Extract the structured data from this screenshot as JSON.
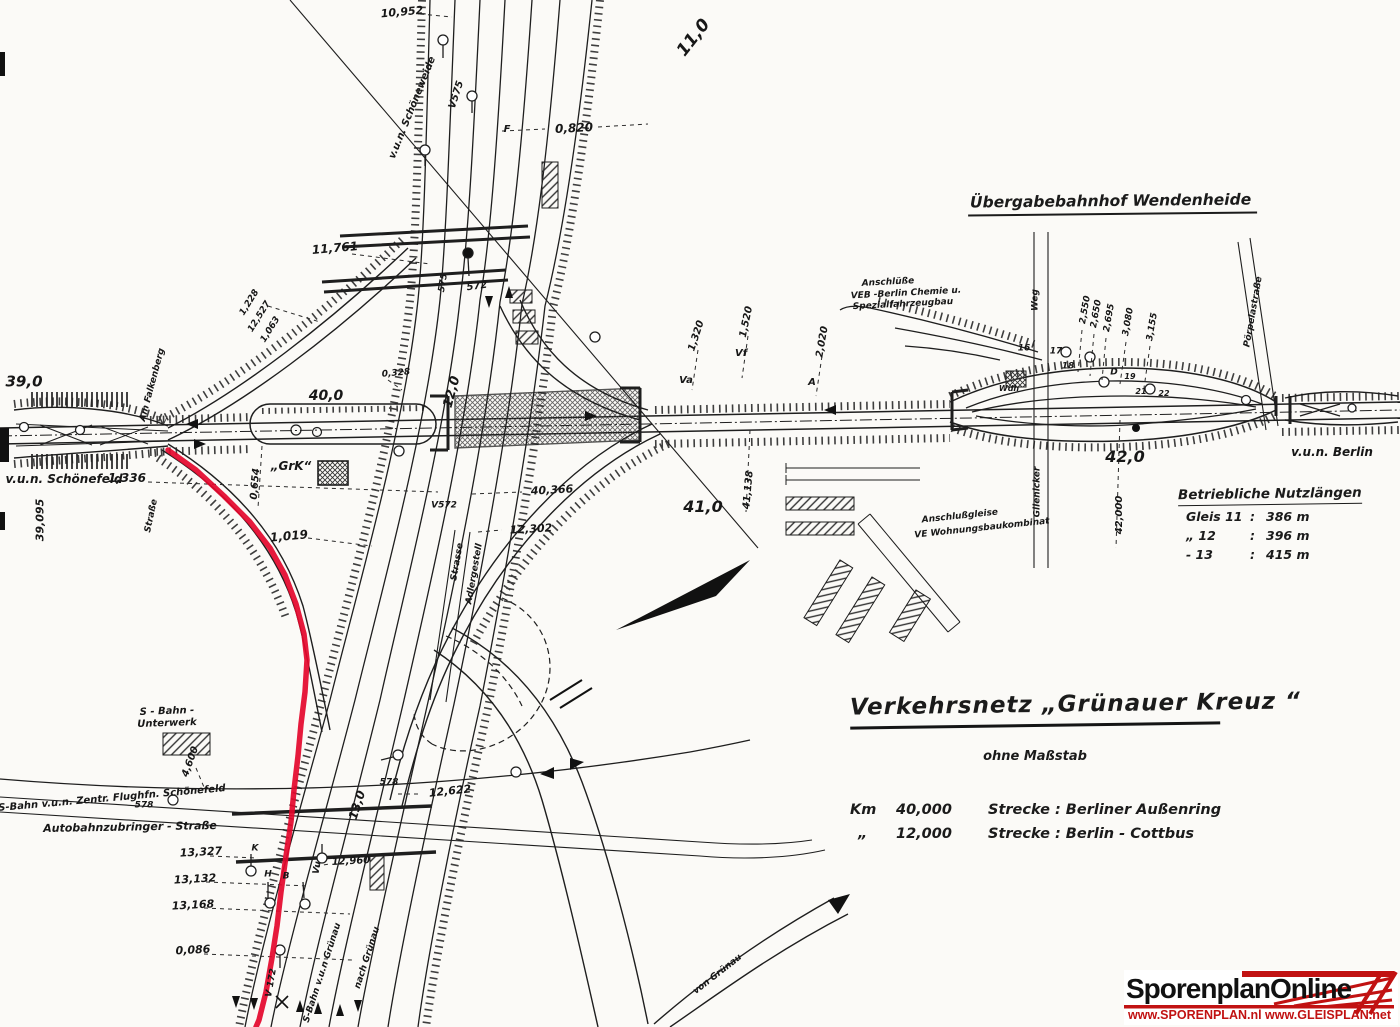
{
  "colors": {
    "ink": "#222222",
    "route_red": "#e4062b",
    "logo_red": "#c11212"
  },
  "station_header": {
    "text": "Übergabebahnhof  Wendenheide"
  },
  "title_block": {
    "title": "Verkehrsnetz  „Grünauer  Kreuz “",
    "subtitle": "ohne Maßstab",
    "rows": [
      {
        "km_label": "Km",
        "km": "40,000",
        "strecke": "Strecke :  Berliner Außenring"
      },
      {
        "km_label": "„",
        "km": "12,000",
        "strecke": "Strecke :  Berlin - Cottbus"
      }
    ]
  },
  "nutzlaengen": {
    "heading": "Betriebliche Nutzlängen",
    "rows": [
      {
        "gleis": "Gleis 11",
        "sep": ":",
        "len": "386 m"
      },
      {
        "gleis": "„     12",
        "sep": ":",
        "len": "396 m"
      },
      {
        "gleis": "-     13",
        "sep": ":",
        "len": "415 m"
      }
    ]
  },
  "logo": {
    "name": "SporenplanOnline",
    "urls": "www.SPORENPLAN.nl   www.GLEISPLAN.net"
  },
  "map_labels": [
    {
      "t": "10,952",
      "x": 402,
      "y": 12,
      "r": -5,
      "s": 11
    },
    {
      "t": "v.u.n. Schöneweide",
      "x": 413,
      "y": 108,
      "r": -68,
      "s": 10
    },
    {
      "t": "V575",
      "x": 457,
      "y": 95,
      "r": -72,
      "s": 10
    },
    {
      "t": "11,0",
      "x": 694,
      "y": 38,
      "r": -52,
      "s": 17
    },
    {
      "t": "F",
      "x": 507,
      "y": 130,
      "r": 0,
      "s": 10
    },
    {
      "t": "0,820",
      "x": 574,
      "y": 128,
      "r": -3,
      "s": 12
    },
    {
      "t": "11,761",
      "x": 335,
      "y": 248,
      "r": -5,
      "s": 12
    },
    {
      "t": "575",
      "x": 444,
      "y": 283,
      "r": -80,
      "s": 9
    },
    {
      "t": "572",
      "x": 477,
      "y": 287,
      "r": -8,
      "s": 10
    },
    {
      "t": "1,228",
      "x": 250,
      "y": 303,
      "r": -58,
      "s": 9
    },
    {
      "t": "12,527",
      "x": 260,
      "y": 317,
      "r": -58,
      "s": 9
    },
    {
      "t": "1,063",
      "x": 271,
      "y": 330,
      "r": -58,
      "s": 9
    },
    {
      "t": "39,0",
      "x": 24,
      "y": 382,
      "r": 0,
      "s": 15
    },
    {
      "t": "v.u.n. Schönefeld",
      "x": 64,
      "y": 479,
      "r": 0,
      "s": 12
    },
    {
      "t": "1,336",
      "x": 127,
      "y": 478,
      "r": 0,
      "s": 12
    },
    {
      "t": "39,095",
      "x": 40,
      "y": 520,
      "r": -90,
      "s": 11
    },
    {
      "t": "Am Falkenberg",
      "x": 153,
      "y": 385,
      "r": -75,
      "s": 9
    },
    {
      "t": "Straße",
      "x": 152,
      "y": 516,
      "r": -78,
      "s": 9
    },
    {
      "t": "40,0",
      "x": 326,
      "y": 396,
      "r": 0,
      "s": 14
    },
    {
      "t": "„GrK“",
      "x": 291,
      "y": 466,
      "r": 0,
      "s": 12
    },
    {
      "t": "0,328",
      "x": 396,
      "y": 374,
      "r": -5,
      "s": 9
    },
    {
      "t": "12,0",
      "x": 452,
      "y": 392,
      "r": -75,
      "s": 13
    },
    {
      "t": "1,019",
      "x": 289,
      "y": 536,
      "r": -5,
      "s": 12
    },
    {
      "t": "0,654",
      "x": 256,
      "y": 484,
      "r": -85,
      "s": 10
    },
    {
      "t": "V572",
      "x": 444,
      "y": 506,
      "r": 0,
      "s": 9
    },
    {
      "t": "40,366",
      "x": 552,
      "y": 490,
      "r": -3,
      "s": 11
    },
    {
      "t": "12,302",
      "x": 531,
      "y": 529,
      "r": -3,
      "s": 11
    },
    {
      "t": "Strasse",
      "x": 458,
      "y": 562,
      "r": -80,
      "s": 9
    },
    {
      "t": "Adlergestell",
      "x": 475,
      "y": 574,
      "r": -80,
      "s": 9
    },
    {
      "t": "41,0",
      "x": 703,
      "y": 507,
      "r": 0,
      "s": 16
    },
    {
      "t": "41,138",
      "x": 749,
      "y": 490,
      "r": -85,
      "s": 10
    },
    {
      "t": "1,320",
      "x": 697,
      "y": 336,
      "r": -72,
      "s": 10
    },
    {
      "t": "1,520",
      "x": 747,
      "y": 322,
      "r": -78,
      "s": 10
    },
    {
      "t": "2,020",
      "x": 823,
      "y": 342,
      "r": -80,
      "s": 10
    },
    {
      "t": "Vf",
      "x": 741,
      "y": 354,
      "r": 0,
      "s": 10
    },
    {
      "t": "Va",
      "x": 686,
      "y": 381,
      "r": 0,
      "s": 10
    },
    {
      "t": "A",
      "x": 812,
      "y": 383,
      "r": 0,
      "s": 10
    },
    {
      "t": "Anschlüße",
      "x": 888,
      "y": 283,
      "r": -3,
      "s": 9
    },
    {
      "t": "VEB -Berlin Chemie u.",
      "x": 906,
      "y": 294,
      "r": -3,
      "s": 9
    },
    {
      "t": "Spezialfahrzeugbau",
      "x": 903,
      "y": 305,
      "r": -3,
      "s": 9
    },
    {
      "t": "Weg",
      "x": 1036,
      "y": 300,
      "r": -90,
      "s": 9
    },
    {
      "t": "2,550",
      "x": 1086,
      "y": 310,
      "r": -80,
      "s": 9
    },
    {
      "t": "2,650",
      "x": 1097,
      "y": 314,
      "r": -80,
      "s": 9
    },
    {
      "t": "2,695",
      "x": 1110,
      "y": 318,
      "r": -80,
      "s": 9
    },
    {
      "t": "3,080",
      "x": 1129,
      "y": 322,
      "r": -80,
      "s": 9
    },
    {
      "t": "3,155",
      "x": 1153,
      "y": 327,
      "r": -80,
      "s": 9
    },
    {
      "t": "16",
      "x": 1024,
      "y": 349,
      "r": 0,
      "s": 9
    },
    {
      "t": "17",
      "x": 1056,
      "y": 352,
      "r": 0,
      "s": 9
    },
    {
      "t": "18",
      "x": 1068,
      "y": 367,
      "r": 0,
      "s": 9
    },
    {
      "t": "D",
      "x": 1114,
      "y": 373,
      "r": 0,
      "s": 9
    },
    {
      "t": "19",
      "x": 1130,
      "y": 377,
      "r": 0,
      "s": 8
    },
    {
      "t": "21",
      "x": 1141,
      "y": 392,
      "r": 0,
      "s": 8
    },
    {
      "t": "22",
      "x": 1164,
      "y": 394,
      "r": 0,
      "s": 8
    },
    {
      "t": "Wdh",
      "x": 1009,
      "y": 389,
      "r": 0,
      "s": 8
    },
    {
      "t": "Pörpelastraße",
      "x": 1254,
      "y": 312,
      "r": -80,
      "s": 9
    },
    {
      "t": "42,0",
      "x": 1125,
      "y": 457,
      "r": 0,
      "s": 16
    },
    {
      "t": "42,000",
      "x": 1120,
      "y": 515,
      "r": -90,
      "s": 10
    },
    {
      "t": "v.u.n. Berlin",
      "x": 1332,
      "y": 452,
      "r": 0,
      "s": 12
    },
    {
      "t": "Glienicker",
      "x": 1038,
      "y": 492,
      "r": -90,
      "s": 9
    },
    {
      "t": "Anschlußgleise",
      "x": 960,
      "y": 517,
      "r": -6,
      "s": 9
    },
    {
      "t": "VE Wohnungsbaukombinat",
      "x": 982,
      "y": 529,
      "r": -6,
      "s": 9
    },
    {
      "t": "S - Bahn -",
      "x": 167,
      "y": 712,
      "r": -2,
      "s": 10
    },
    {
      "t": "Unterwerk",
      "x": 167,
      "y": 724,
      "r": -2,
      "s": 10
    },
    {
      "t": "4,600",
      "x": 191,
      "y": 762,
      "r": -70,
      "s": 10
    },
    {
      "t": "S-Bahn v.u.n. Zentr. Flughfn. Schönefeld",
      "x": 112,
      "y": 799,
      "r": -5,
      "s": 10
    },
    {
      "t": "578",
      "x": 144,
      "y": 806,
      "r": 0,
      "s": 9
    },
    {
      "t": "Autobahnzubringer - Straße",
      "x": 130,
      "y": 827,
      "r": -1,
      "s": 11
    },
    {
      "t": "13,0",
      "x": 357,
      "y": 805,
      "r": -72,
      "s": 12
    },
    {
      "t": "578",
      "x": 389,
      "y": 783,
      "r": 0,
      "s": 9
    },
    {
      "t": "12,622",
      "x": 450,
      "y": 791,
      "r": -6,
      "s": 11
    },
    {
      "t": "13,327",
      "x": 201,
      "y": 852,
      "r": -3,
      "s": 11
    },
    {
      "t": "13,132",
      "x": 195,
      "y": 879,
      "r": -3,
      "s": 11
    },
    {
      "t": "13,168",
      "x": 193,
      "y": 905,
      "r": -3,
      "s": 11
    },
    {
      "t": "0,086",
      "x": 193,
      "y": 950,
      "r": -3,
      "s": 11
    },
    {
      "t": "12,960",
      "x": 351,
      "y": 862,
      "r": -3,
      "s": 10
    },
    {
      "t": "K",
      "x": 255,
      "y": 849,
      "r": 0,
      "s": 9
    },
    {
      "t": "H",
      "x": 268,
      "y": 875,
      "r": 0,
      "s": 9
    },
    {
      "t": "B",
      "x": 286,
      "y": 877,
      "r": 0,
      "s": 9
    },
    {
      "t": "Vu",
      "x": 318,
      "y": 868,
      "r": -80,
      "s": 9
    },
    {
      "t": "V 172",
      "x": 272,
      "y": 983,
      "r": -80,
      "s": 9
    },
    {
      "t": "S-Bahn  v.u.n  Grünau",
      "x": 323,
      "y": 973,
      "r": -72,
      "s": 9
    },
    {
      "t": "nach Grünau",
      "x": 368,
      "y": 958,
      "r": -72,
      "s": 9
    },
    {
      "t": "von Grünau",
      "x": 718,
      "y": 975,
      "r": -38,
      "s": 9
    }
  ]
}
